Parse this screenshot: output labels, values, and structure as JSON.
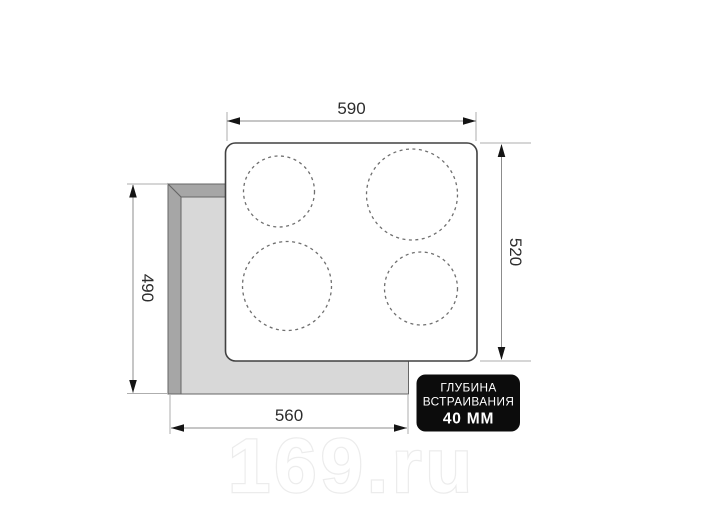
{
  "diagram": {
    "title": "cooktop-installation-dimensions",
    "dimensions": {
      "top_width": "590",
      "right_height": "520",
      "left_height": "490",
      "bottom_width": "560"
    },
    "badge": {
      "line1": "ГЛУБИНА",
      "line2": "ВСТРАИВАНИЯ",
      "line3": "40 ММ"
    },
    "watermark": "169.ru",
    "burner_count": "4"
  },
  "colors": {
    "background": "#ffffff",
    "panel_fill": "#ffffff",
    "panel_stroke": "#414141",
    "cutout_fill": "#d8d8d8",
    "cutout_bevel": "#a6a6a6",
    "cutout_stroke": "#666666",
    "burner_stroke": "#6f6f6f",
    "dimension_line": "#8c8c8c",
    "extension_line": "#aeaeae",
    "arrow": "#141414",
    "dimension_text": "#2d2d2d",
    "badge_bg": "#0c0c0c",
    "badge_text": "#ffffff",
    "watermark_outline": "#ececec"
  }
}
